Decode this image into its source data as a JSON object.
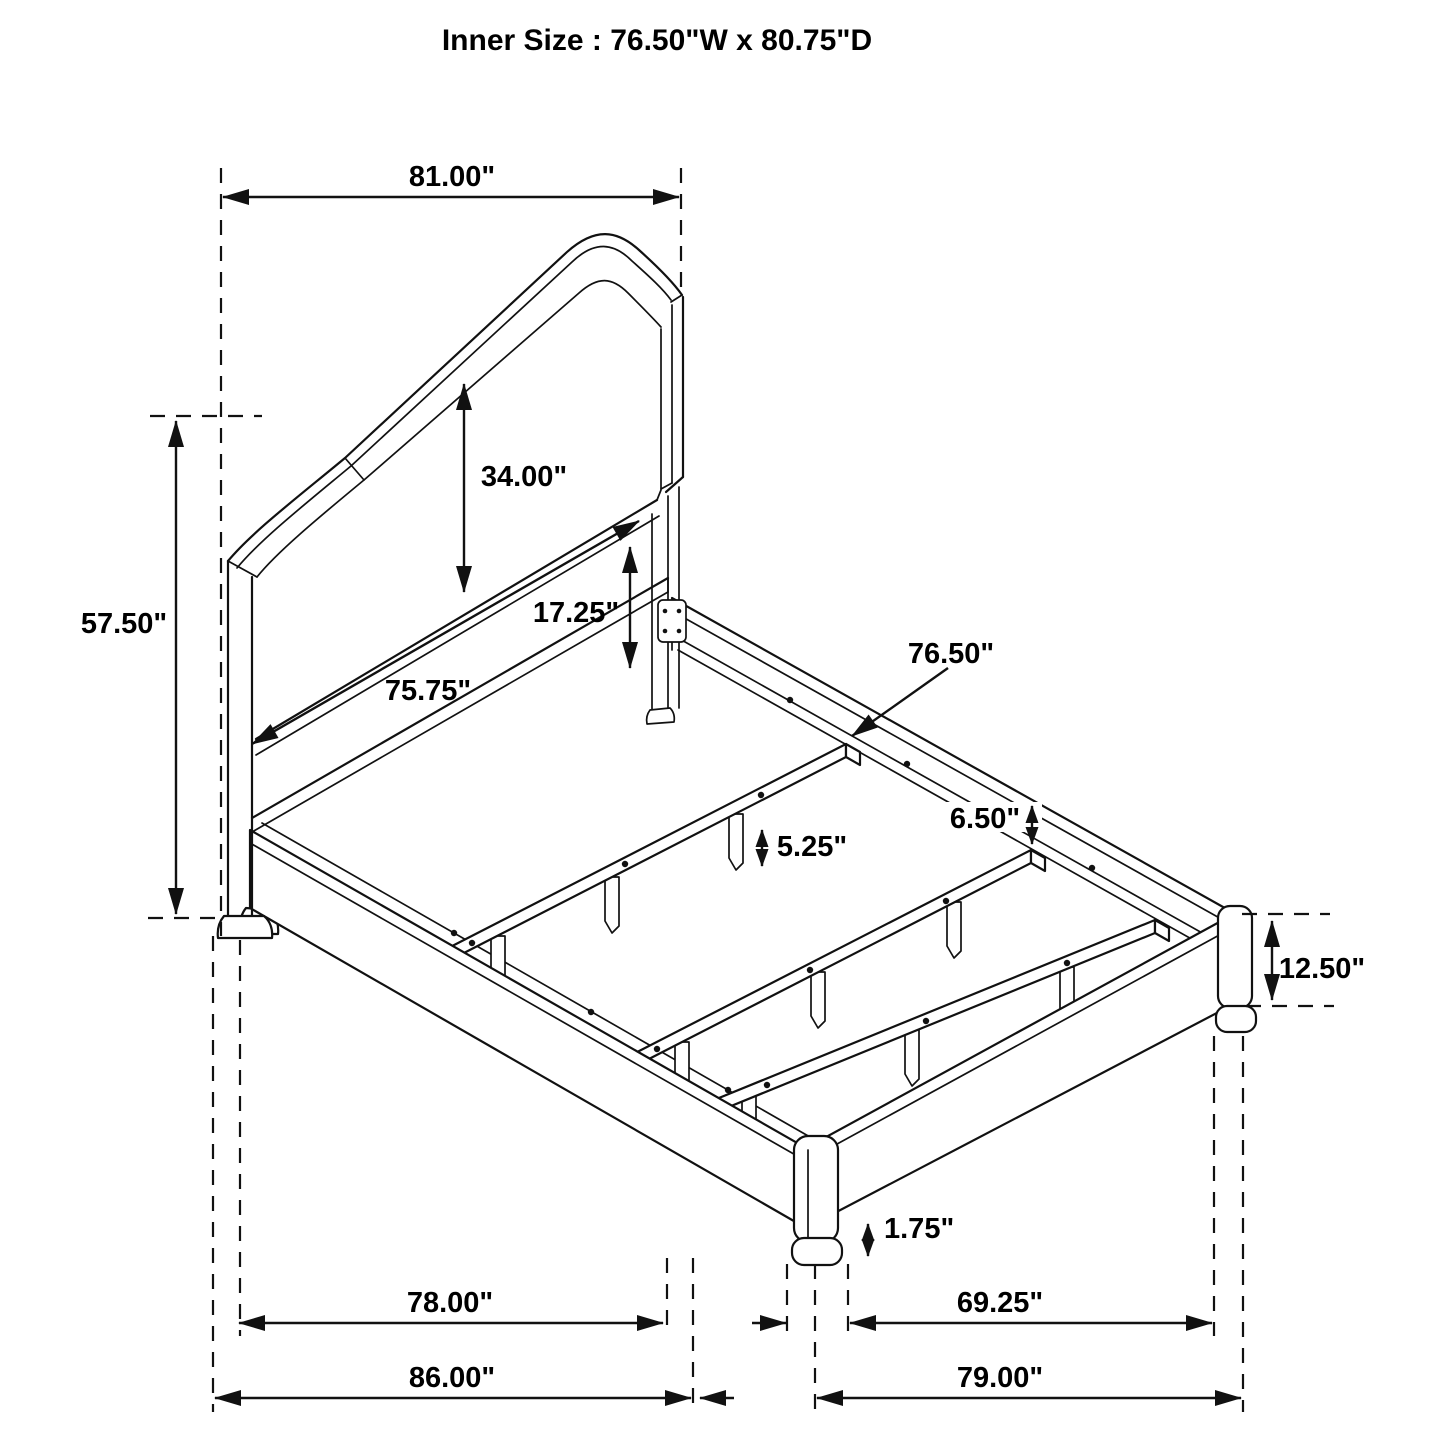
{
  "title": "Inner Size : 76.50\"W x 80.75\"D",
  "dims": {
    "headboard_width": "81.00\"",
    "headboard_height": "57.50\"",
    "panel_height": "34.00\"",
    "panel_to_rail": "17.25\"",
    "headboard_rail_length": "75.75\"",
    "slat_length": "76.50\"",
    "slat_end_gap": "6.50\"",
    "slat_leg_height": "5.25\"",
    "side_rail_height": "12.50\"",
    "foot_height": "1.75\"",
    "frame_length_inner": "78.00\"",
    "overall_length": "86.00\"",
    "footboard_inner_width": "69.25\"",
    "footboard_outer_width": "79.00\""
  }
}
